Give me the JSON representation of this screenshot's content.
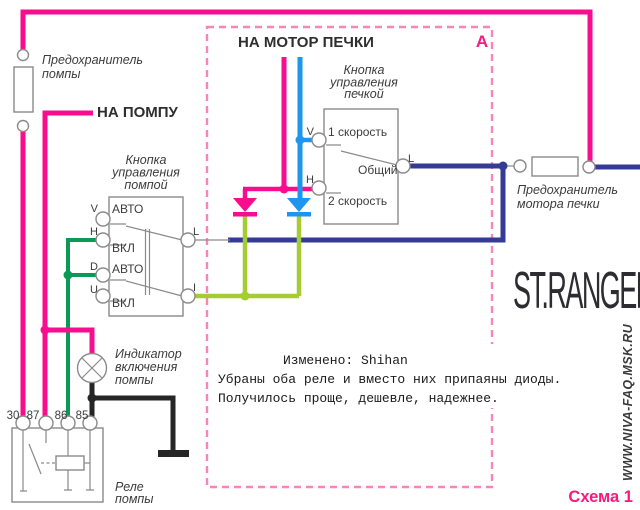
{
  "diagram": {
    "zone_label": "A",
    "caption": "Схема 1",
    "watermark": "ST.RANGER",
    "site": "WWW.NIVA-FAQ.MSK.RU"
  },
  "labels": {
    "pump_fuse_line1": "Предохранитель",
    "pump_fuse_line2": "помпы",
    "to_pump": "НА ПОМПУ",
    "to_heater_motor": "НА МОТОР ПЕЧКИ",
    "pump_switch_title_line1": "Кнопка",
    "pump_switch_title_line2": "управления",
    "pump_switch_title_line3": "помпой",
    "heater_switch_title_line1": "Кнопка",
    "heater_switch_title_line2": "управления",
    "heater_switch_title_line3": "печкой",
    "heater_fuse_line1": "Предохранитель",
    "heater_fuse_line2": "мотора печки",
    "indicator_line1": "Индикатор",
    "indicator_line2": "включения",
    "indicator_line3": "помпы",
    "relay_line1": "Реле",
    "relay_line2": "помпы"
  },
  "pump_switch": {
    "left_terminals": [
      "V",
      "H",
      "D",
      "U"
    ],
    "right_terminals": [
      "L",
      "I"
    ],
    "positions": [
      "АВТО",
      "ВКЛ",
      "АВТО",
      "ВКЛ"
    ]
  },
  "heater_switch": {
    "left_terminals": [
      "V",
      "H"
    ],
    "right_terminal": "L",
    "speed1": "1 скорость",
    "common": "Общий",
    "speed2": "2 скорость"
  },
  "relay": {
    "pins": [
      "30",
      "87",
      "86",
      "85"
    ]
  },
  "note": {
    "line1": "Изменено: Shihan",
    "line2": "Убраны оба реле и вместо них припаяны диоды.",
    "line3": "Получилось проще, дешевле, надежнее."
  },
  "colors": {
    "pump_wire_pink": "#F80D8E",
    "heater_wire_blue": "#1E96F0",
    "output_wire_navy": "#343A96",
    "control_wire_green": "#0A9A56",
    "diode_wire_chartreuse": "#A5CC33",
    "ground_wire_black": "#262626",
    "dashed_border_pink": "#F884BC",
    "accent_pink": "#F8187E",
    "component_gray": "#8A8A8A"
  }
}
